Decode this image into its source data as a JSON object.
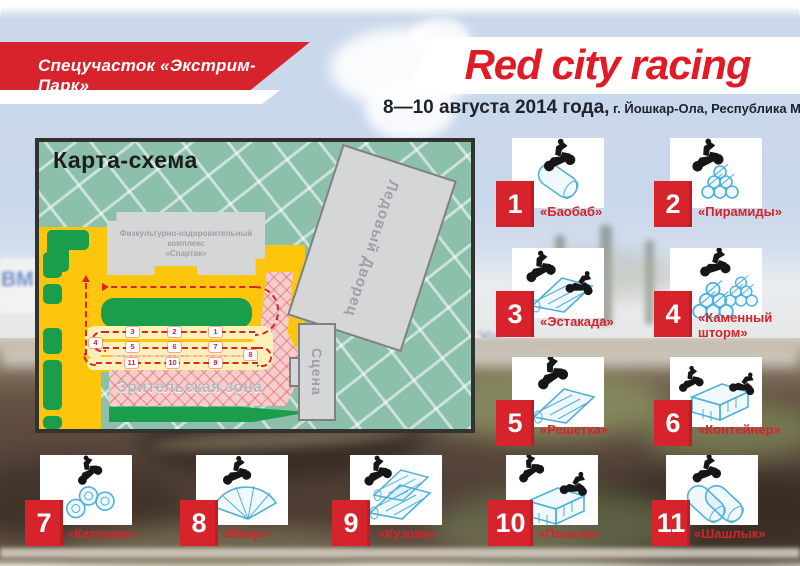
{
  "banner": {
    "label": "Спецучасток «Экстрим-Парк»"
  },
  "title": "Red city racing",
  "subtitle": {
    "date": "8—10 августа 2014 года,",
    "place": " г. Йошкар-Ола, Республика Марий Эл"
  },
  "map": {
    "title": "Карта-схема",
    "labels": {
      "sport_complex_line1": "Физкультурно-оздоровительный",
      "sport_complex_line2": "комплекс",
      "sport_complex_line3": "«Спартак»",
      "ice_palace": "Ледовый Дворец",
      "stage": "Сцена",
      "spectator_zone": "Зрительская зона"
    },
    "track_points": [
      "1",
      "2",
      "3",
      "4",
      "5",
      "6",
      "7",
      "8",
      "9",
      "10",
      "11"
    ]
  },
  "obstacles": [
    {
      "num": "1",
      "label": "«Баобаб»"
    },
    {
      "num": "2",
      "label": "«Пирамиды»"
    },
    {
      "num": "3",
      "label": "«Эстакада»"
    },
    {
      "num": "4",
      "label": "«Каменный шторм»"
    },
    {
      "num": "5",
      "label": "«Решетка»"
    },
    {
      "num": "6",
      "label": "«Контейнер»"
    },
    {
      "num": "7",
      "label": "«Катушки»"
    },
    {
      "num": "8",
      "label": "«Веер»"
    },
    {
      "num": "9",
      "label": "«Кузова»"
    },
    {
      "num": "10",
      "label": "«Пеньки»"
    },
    {
      "num": "11",
      "label": "«Шашлык»"
    }
  ],
  "background_photo_text": {
    "left_banner": "ВМ",
    "mid_banner": "Yo"
  },
  "colors": {
    "accent_red": "#d6232c",
    "title_red": "#e01b26",
    "map_teal": "#8cc0ab",
    "road_yellow": "#fdc60d",
    "grass_green": "#1b9e4b",
    "spectator_pink": "#f6cdcd",
    "sketch_blue": "#4fb0da",
    "sky_blue": "#c9d7eb"
  }
}
